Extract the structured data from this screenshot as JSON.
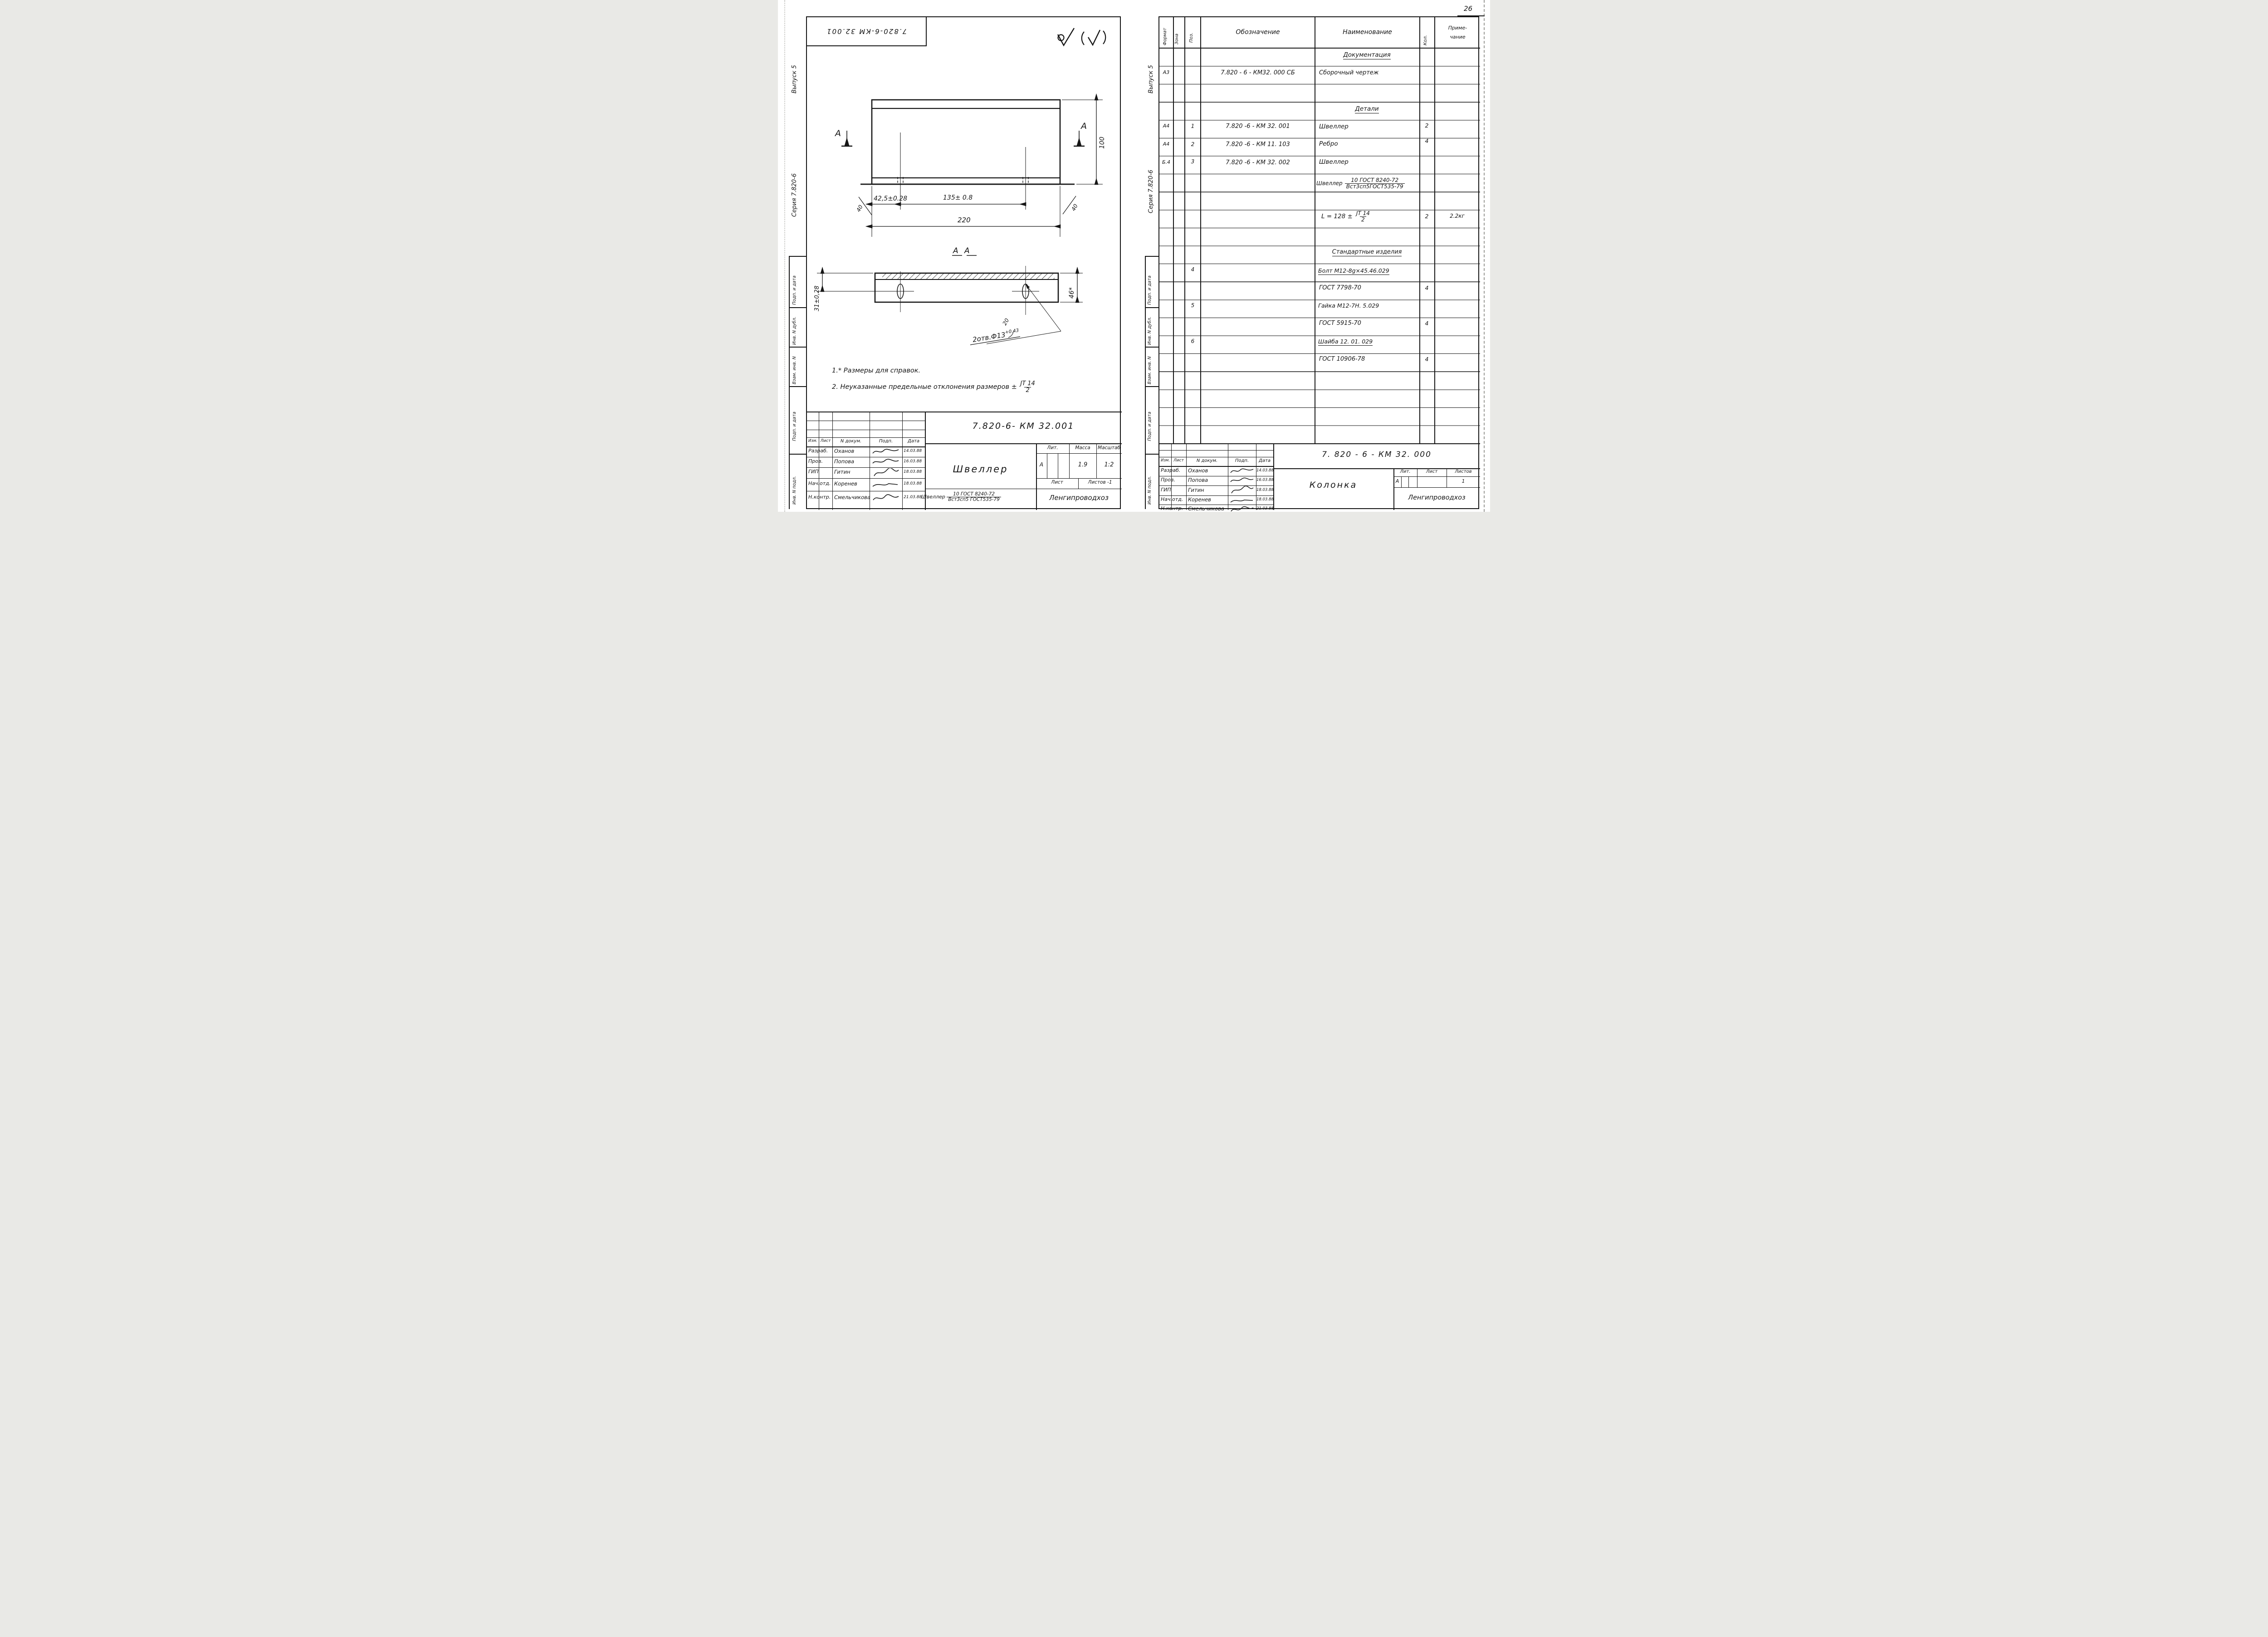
{
  "page_number": "26",
  "roughness_icons": [
    "roughness-check-circle-icon",
    "roughness-check-in-brackets-icon"
  ],
  "left": {
    "corner_stamp": "7.820-6-КМ 32.001",
    "margin_issue": "Выпуск 5",
    "margin_series": "Серия  7.820-6",
    "stamps": [
      "Подп. и дата",
      "Инв. N дубл.",
      "Взам. инв. N",
      "Подп. и дата",
      "Инв. N подл."
    ],
    "view": {
      "dim_offset": "42,5±0.28",
      "dim_spacing": "135± 0.8",
      "dim_total": "220",
      "dim_height": "100",
      "bevel_left": "40",
      "bevel_right": "40",
      "section_letter_left": "А",
      "section_letter_right": "А"
    },
    "section": {
      "title": "А    А",
      "dim_flange": "31±0,28",
      "dim_height": "46*",
      "dim_angle": "20",
      "holes_label": "2отв.Ф13",
      "holes_tol": "+0.43"
    },
    "notes": {
      "line1": "1.* Размеры  для  справок.",
      "line2": "2. Неуказанные  предельные  отклонения  размеров ±",
      "frac_num": "JT 14",
      "frac_den": "2"
    },
    "doc_number": "7.820-6-  КМ 32.001",
    "tb": {
      "head": [
        "Изм.",
        "Лист",
        "N докум.",
        "Подп.",
        "Дата"
      ],
      "rows": [
        {
          "role": "Разраб.",
          "name": "Оханов",
          "date": "14.03.88"
        },
        {
          "role": "Пров.",
          "name": "Попова",
          "date": "16.03.88"
        },
        {
          "role": "ГИП",
          "name": "Гитин",
          "date": "18.03.88"
        },
        {
          "role": "Нач.отд.",
          "name": "Коренев",
          "date": "18.03.88"
        },
        {
          "role": "Н.контр.",
          "name": "Смельчикова",
          "date": "21.03.88"
        }
      ],
      "part_name": "Швеллер",
      "lit_label": "Лит.",
      "mass_label": "Масса",
      "scale_label": "Масштаб",
      "lit": "А",
      "mass": "1.9",
      "scale": "1:2",
      "sheet_label": "Лист",
      "sheets_label": "Листов -1",
      "material_prefix": "Швеллер",
      "material_num": "10 ГОСТ 8240-72",
      "material_den": "Вст3сп5 ГОСТ535-79",
      "org": "Ленгипроводхоз"
    }
  },
  "right": {
    "margin_issue": "Выпуск 5",
    "margin_series": "Серия  7.820-6",
    "stamps": [
      "Подп. и дата",
      "Инв. N дубл.",
      "Взам. инв. N",
      "Подп. и дата",
      "Инв. N подл."
    ],
    "spec": {
      "h_format": "Формат",
      "h_zone": "Зона",
      "h_pos": "Поз.",
      "h_desig": "Обозначение",
      "h_name": "Наименование",
      "h_qty": "Кол.",
      "h_note1": "Приме-",
      "h_note2": "чание",
      "sec_docs": "Документация",
      "doc_row": {
        "format": "А3",
        "desig": "7.820 - 6 -  КМ32. 000 СБ",
        "name": "Сборочный  чертеж"
      },
      "sec_parts": "Детали",
      "part_rows": [
        {
          "format": "А4",
          "pos": "1",
          "desig": "7.820 -6 -  КМ 32. 001",
          "name": "Швеллер",
          "qty": "2"
        },
        {
          "format": "А4",
          "pos": "2",
          "desig": "7.820 -6 -  КМ 11. 103",
          "name": "Ребро",
          "qty": "4"
        },
        {
          "format": "Б.4",
          "pos": "3",
          "desig": "7.820 -6 - КМ 32. 002",
          "name": "Швеллер",
          "qty": ""
        }
      ],
      "material": {
        "prefix": "Швеллер",
        "num": "10 ГОСТ 8240-72",
        "den": "Вст3сп5ГОСТ535-79"
      },
      "length_row": {
        "prefix": "L  =  128 ±",
        "num": "JT 14",
        "den": "2",
        "qty": "2",
        "note": "2.2кг"
      },
      "sec_std": "Стандартные  изделия",
      "std_rows": [
        {
          "pos": "4",
          "name": "Болт М12-8g×45.46.029",
          "qty": ""
        },
        {
          "pos": "",
          "name": "ГОСТ 7798-70",
          "qty": "4"
        },
        {
          "pos": "5",
          "name": "Гайка М12-7Н. 5.029",
          "qty": ""
        },
        {
          "pos": "",
          "name": "ГОСТ 5915-70",
          "qty": "4"
        },
        {
          "pos": "6",
          "name": "Шайба   12. 01. 029",
          "qty": ""
        },
        {
          "pos": "",
          "name": "ГОСТ 10906-78",
          "qty": "4"
        }
      ]
    },
    "tb": {
      "doc_number": "7. 820 - 6 -  КМ   32. 000",
      "head": [
        "Изм.",
        "Лист",
        "N докум.",
        "Подп.",
        "Дата"
      ],
      "rows": [
        {
          "role": "Разраб.",
          "name": "Оханов",
          "date": "14.03.88"
        },
        {
          "role": "Пров.",
          "name": "Попова",
          "date": "16.03.88"
        },
        {
          "role": "ГИП",
          "name": "Гитин",
          "date": "18.03.88"
        },
        {
          "role": "Нач.отд.",
          "name": "Коренев",
          "date": "18.03.88"
        },
        {
          "role": "Н.контр.",
          "name": "Смельчикова",
          "date": "21.03.88"
        }
      ],
      "obj_name": "Колонка",
      "lit_label": "Лит.",
      "sheet_label": "Лист",
      "sheets_label": "Листов",
      "lit": "А",
      "sheets": "1",
      "org": "Ленгипроводхоз"
    }
  }
}
